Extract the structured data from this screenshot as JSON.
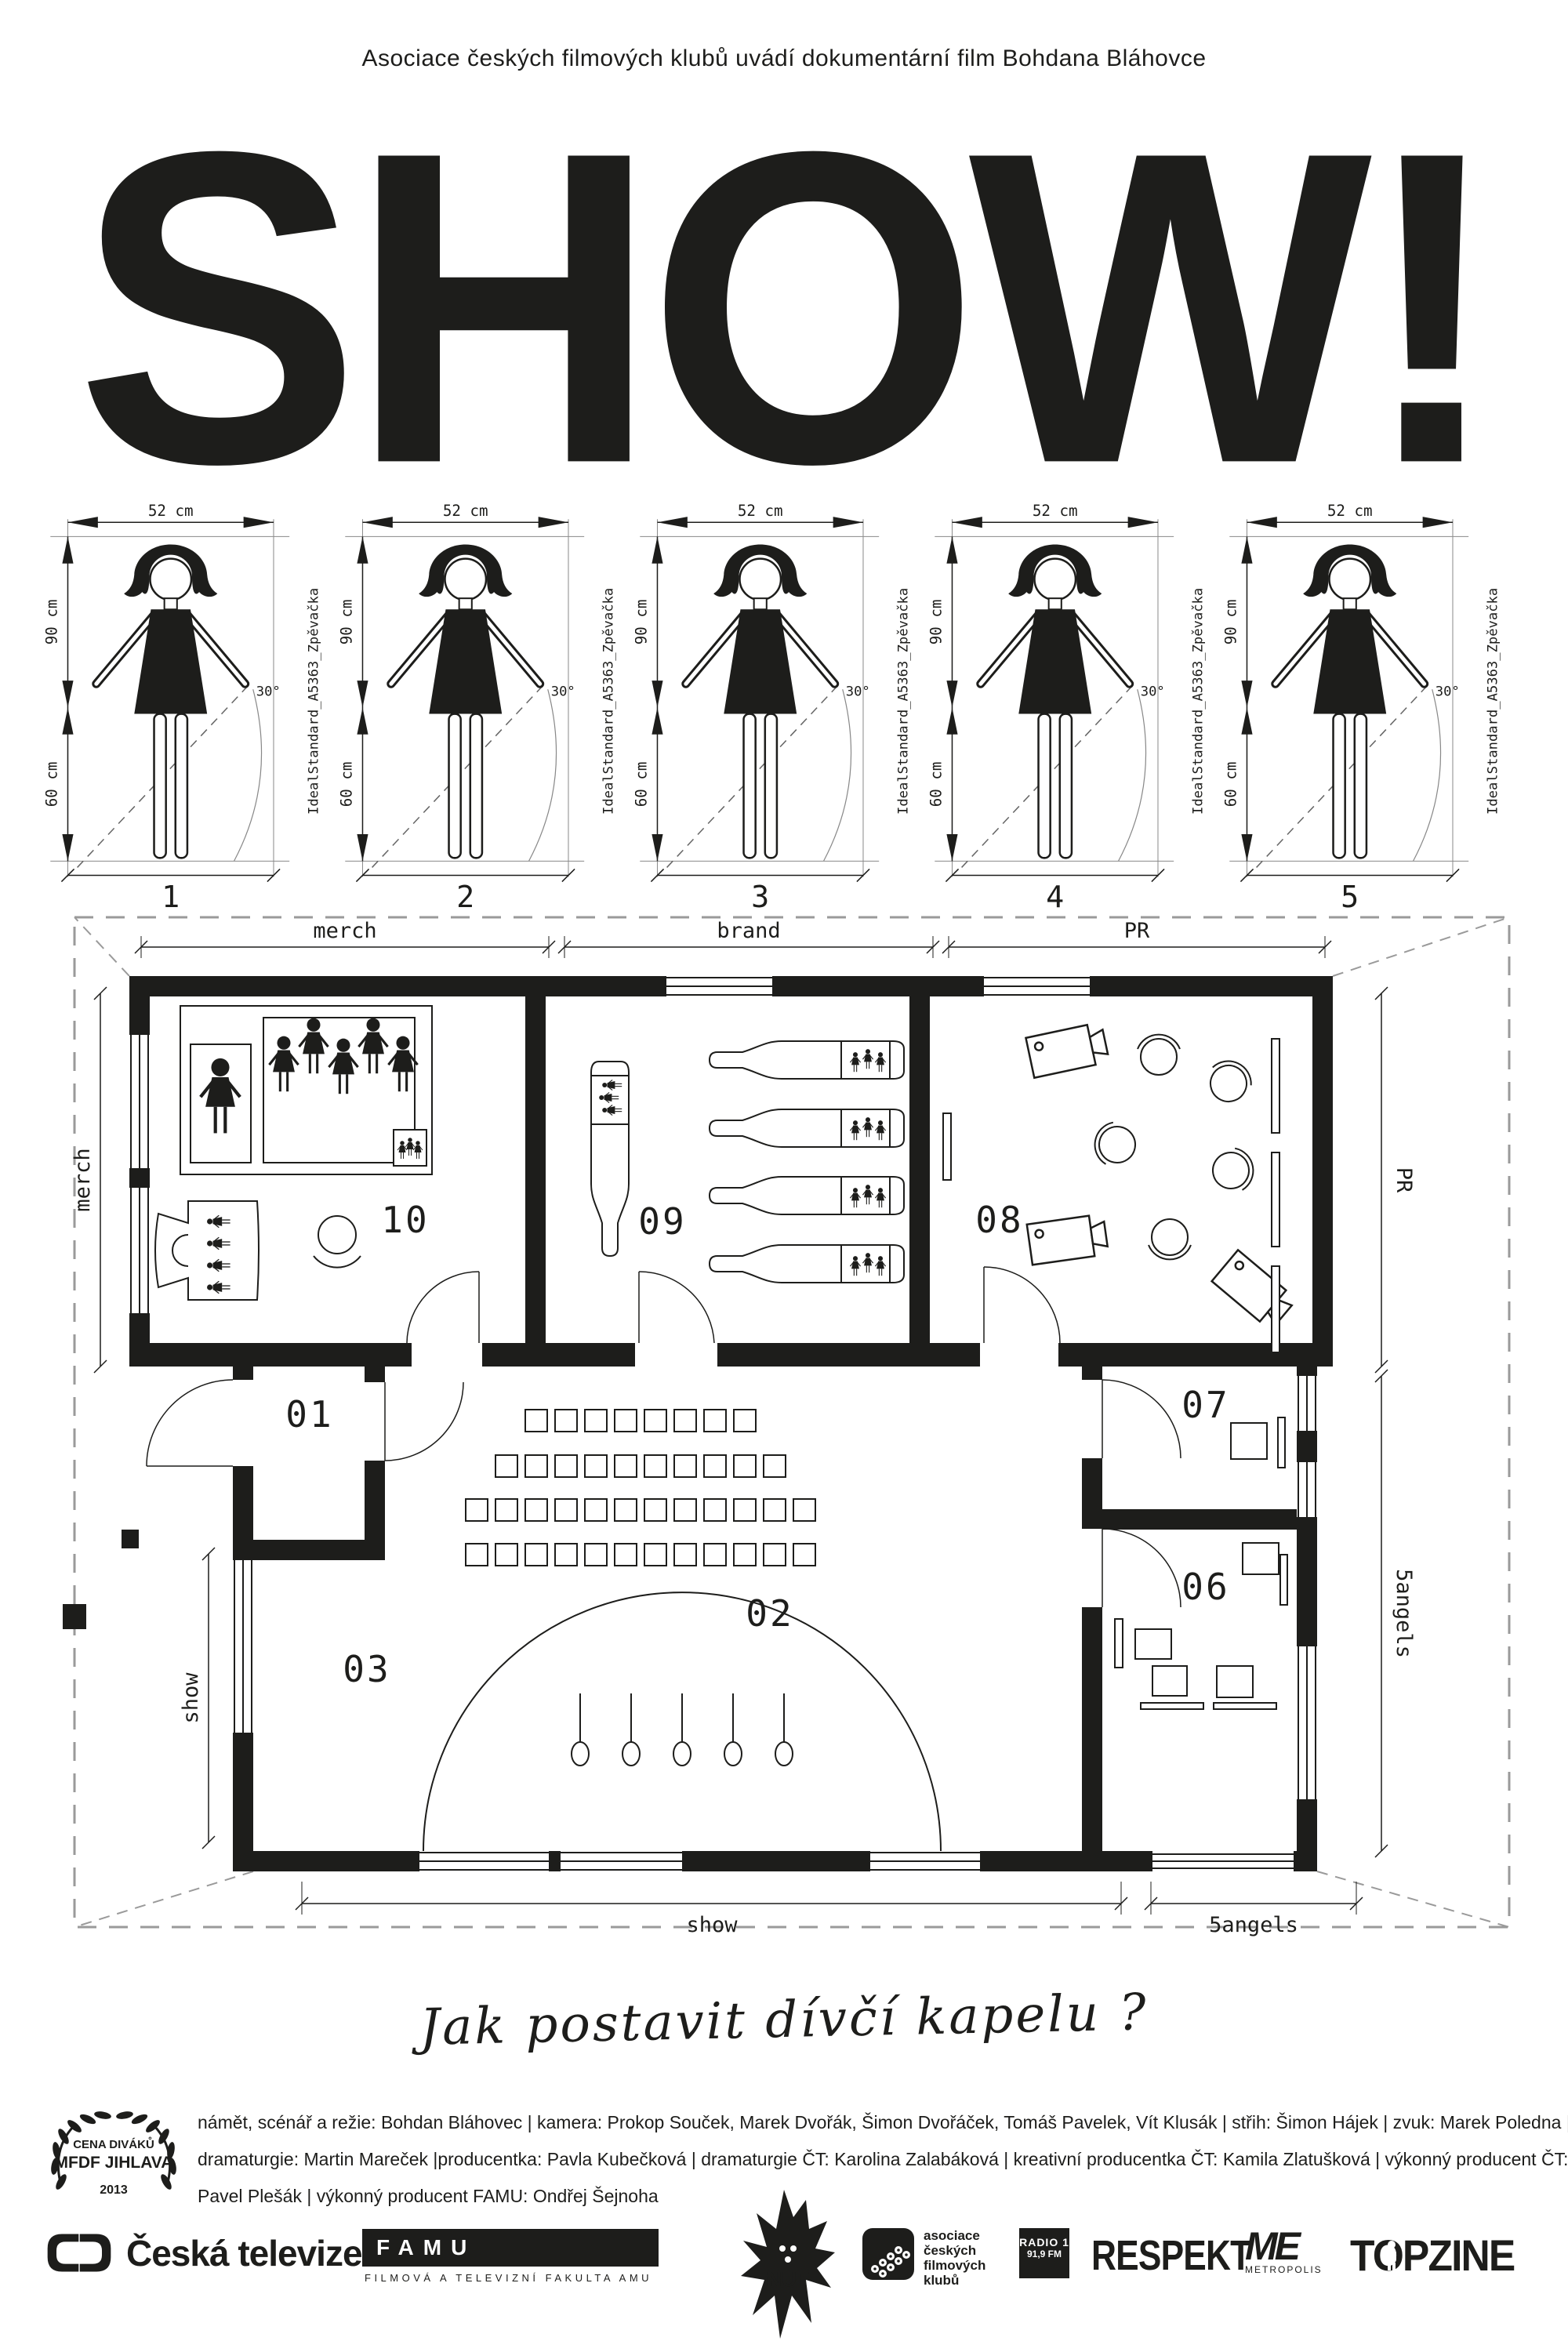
{
  "poster": {
    "tagline": "Asociace českých filmových klubů uvádí dokumentární film Bohdana Bláhovce",
    "title": "SHOW!",
    "question": "Jak postavit dívčí kapelu ?"
  },
  "figure_diagrams": {
    "width_label": "52 cm",
    "height_upper_label": "90 cm",
    "height_lower_label": "60 cm",
    "angle_label": "30°",
    "side_label": "IdealStandard_A5363_Zpěvačka",
    "items": [
      {
        "number": "1"
      },
      {
        "number": "2"
      },
      {
        "number": "3"
      },
      {
        "number": "4"
      },
      {
        "number": "5"
      }
    ]
  },
  "floorplan": {
    "dimensions": {
      "top_left": "merch",
      "top_center": "brand",
      "top_right": "PR",
      "left_upper": "merch",
      "left_lower": "show",
      "right_upper": "PR",
      "right_lower": "5angels",
      "bottom_left": "show",
      "bottom_right": "5angels"
    },
    "rooms": {
      "r01": "01",
      "r02": "02",
      "r03": "03",
      "r06": "06",
      "r07": "07",
      "r08": "08",
      "r09": "09",
      "r10": "10"
    }
  },
  "credits": {
    "line1": "námět, scénář a režie: Bohdan Bláhovec | kamera: Prokop Souček, Marek Dvořák, Šimon Dvořáček, Tomáš Pavelek, Vít Klusák | střih: Šimon Hájek | zvuk: Marek Poledna |",
    "line2": "dramaturgie: Martin Mareček |producentka: Pavla Kubečková | dramaturgie ČT: Karolina Zalabáková | kreativní producentka ČT: Kamila Zlatušková | výkonný producent ČT:",
    "line3": "Pavel Plešák | výkonný producent FAMU: Ondřej Šejnoha"
  },
  "award": {
    "line1": "CENA DIVÁKŮ",
    "line2": "MFDF JIHLAVA",
    "line3": "2013"
  },
  "logos": {
    "ceska_televize": "Česká televize",
    "famu": "FAMU",
    "famu_sub": "FILMOVÁ A TELEVIZNÍ FAKULTA AMU",
    "nut": "NUT",
    "acfk_line1": "asociace",
    "acfk_line2": "českých",
    "acfk_line3": "filmových",
    "acfk_line4": "klubů",
    "radio_line1": "RADIO 1",
    "radio_line2": "91,9 FM",
    "respekt": "RESPEKT",
    "metropolis_me": "ME",
    "metropolis": "METROPOLIS",
    "topzine": "TOPZINE"
  },
  "colors": {
    "ink": "#1d1d1b",
    "paper": "#ffffff"
  }
}
